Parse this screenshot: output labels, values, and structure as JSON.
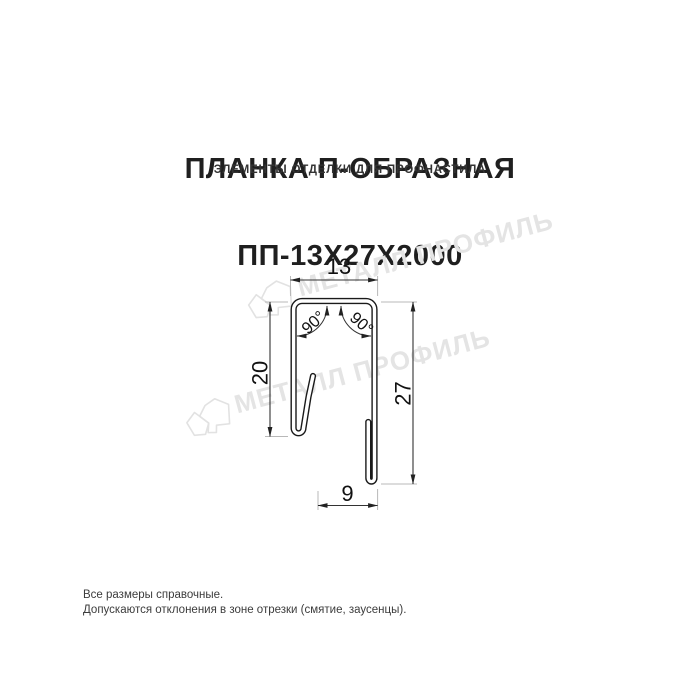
{
  "header": {
    "title_line1": "ПЛАНКА П-ОБРАЗНАЯ",
    "title_line2": "ПП-13Х27Х2000",
    "subtitle": "ЭЛЕМЕНТЫ ОТДЕЛКИ ДЛЯ ПРОФНАСТИЛА"
  },
  "drawing": {
    "dims": {
      "width_top": "13",
      "height_left": "20",
      "height_right": "27",
      "width_bottom": "9",
      "angle_left": "90°",
      "angle_right": "90°"
    },
    "watermark": {
      "text": "МЕТАЛЛ ПРОФИЛЬ",
      "color": "#e4e4e4"
    },
    "colors": {
      "outline": "#1a1a1a",
      "dimension_line": "#333333",
      "extension_line": "#b8b8b8"
    }
  },
  "footer": {
    "line1": "Все размеры справочные.",
    "line2": "Допускаются отклонения в зоне отрезки (смятие, заусенцы)."
  }
}
